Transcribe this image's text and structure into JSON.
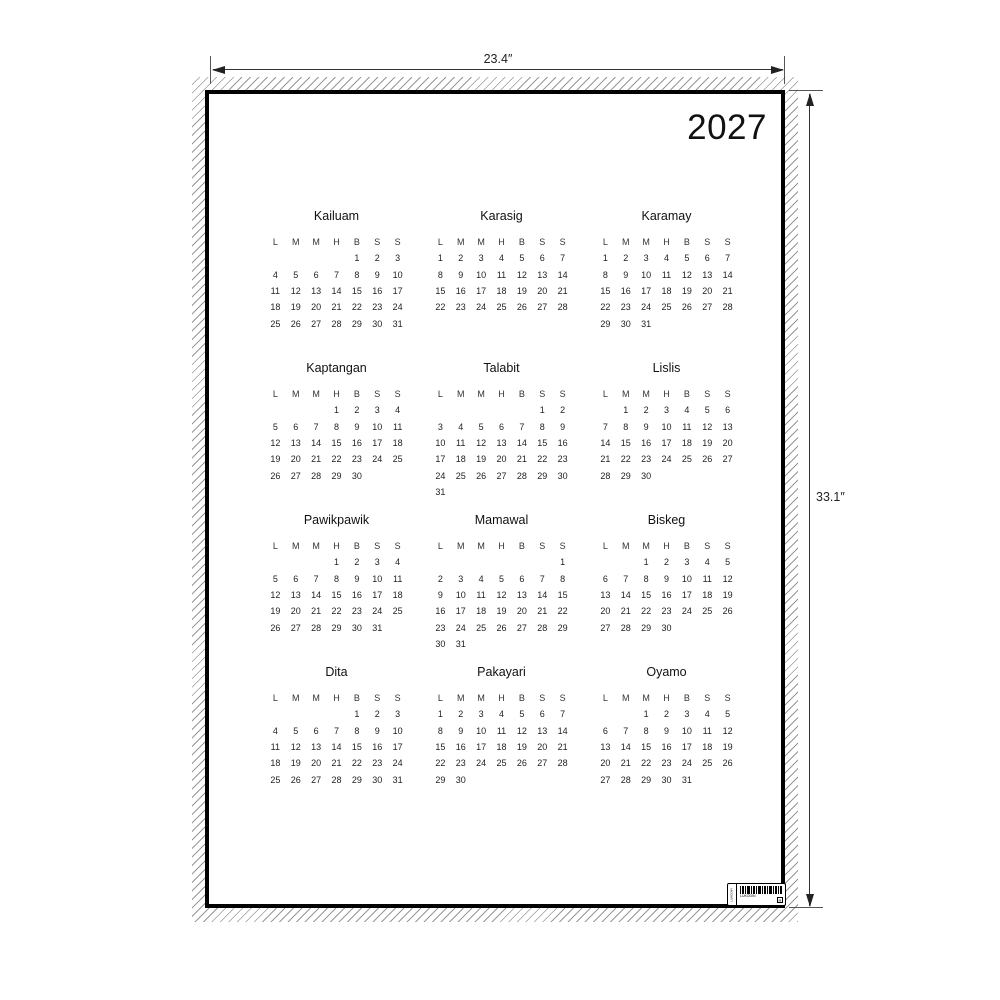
{
  "year": "2027",
  "dimensions": {
    "width_label": "23.4″",
    "height_label": "33.1″"
  },
  "weekday_letters": [
    "L",
    "M",
    "M",
    "H",
    "B",
    "S",
    "S"
  ],
  "months": [
    {
      "name": "Kailuam",
      "weeks": [
        [
          "",
          "",
          "",
          "",
          "1",
          "2",
          "3"
        ],
        [
          "4",
          "5",
          "6",
          "7",
          "8",
          "9",
          "10"
        ],
        [
          "11",
          "12",
          "13",
          "14",
          "15",
          "16",
          "17"
        ],
        [
          "18",
          "19",
          "20",
          "21",
          "22",
          "23",
          "24"
        ],
        [
          "25",
          "26",
          "27",
          "28",
          "29",
          "30",
          "31"
        ]
      ]
    },
    {
      "name": "Karasig",
      "weeks": [
        [
          "1",
          "2",
          "3",
          "4",
          "5",
          "6",
          "7"
        ],
        [
          "8",
          "9",
          "10",
          "11",
          "12",
          "13",
          "14"
        ],
        [
          "15",
          "16",
          "17",
          "18",
          "19",
          "20",
          "21"
        ],
        [
          "22",
          "23",
          "24",
          "25",
          "26",
          "27",
          "28"
        ]
      ]
    },
    {
      "name": "Karamay",
      "weeks": [
        [
          "1",
          "2",
          "3",
          "4",
          "5",
          "6",
          "7"
        ],
        [
          "8",
          "9",
          "10",
          "11",
          "12",
          "13",
          "14"
        ],
        [
          "15",
          "16",
          "17",
          "18",
          "19",
          "20",
          "21"
        ],
        [
          "22",
          "23",
          "24",
          "25",
          "26",
          "27",
          "28"
        ],
        [
          "29",
          "30",
          "31",
          "",
          "",
          "",
          ""
        ]
      ]
    },
    {
      "name": "Kaptangan",
      "weeks": [
        [
          "",
          "",
          "",
          "1",
          "2",
          "3",
          "4"
        ],
        [
          "5",
          "6",
          "7",
          "8",
          "9",
          "10",
          "11"
        ],
        [
          "12",
          "13",
          "14",
          "15",
          "16",
          "17",
          "18"
        ],
        [
          "19",
          "20",
          "21",
          "22",
          "23",
          "24",
          "25"
        ],
        [
          "26",
          "27",
          "28",
          "29",
          "30",
          "",
          ""
        ]
      ]
    },
    {
      "name": "Talabit",
      "weeks": [
        [
          "",
          "",
          "",
          "",
          "",
          "1",
          "2"
        ],
        [
          "3",
          "4",
          "5",
          "6",
          "7",
          "8",
          "9"
        ],
        [
          "10",
          "11",
          "12",
          "13",
          "14",
          "15",
          "16"
        ],
        [
          "17",
          "18",
          "19",
          "20",
          "21",
          "22",
          "23"
        ],
        [
          "24",
          "25",
          "26",
          "27",
          "28",
          "29",
          "30"
        ],
        [
          "31",
          "",
          "",
          "",
          "",
          "",
          ""
        ]
      ]
    },
    {
      "name": "Lislis",
      "weeks": [
        [
          "",
          "1",
          "2",
          "3",
          "4",
          "5",
          "6"
        ],
        [
          "7",
          "8",
          "9",
          "10",
          "11",
          "12",
          "13"
        ],
        [
          "14",
          "15",
          "16",
          "17",
          "18",
          "19",
          "20"
        ],
        [
          "21",
          "22",
          "23",
          "24",
          "25",
          "26",
          "27"
        ],
        [
          "28",
          "29",
          "30",
          "",
          "",
          "",
          ""
        ]
      ]
    },
    {
      "name": "Pawikpawik",
      "weeks": [
        [
          "",
          "",
          "",
          "1",
          "2",
          "3",
          "4"
        ],
        [
          "5",
          "6",
          "7",
          "8",
          "9",
          "10",
          "11"
        ],
        [
          "12",
          "13",
          "14",
          "15",
          "16",
          "17",
          "18"
        ],
        [
          "19",
          "20",
          "21",
          "22",
          "23",
          "24",
          "25"
        ],
        [
          "26",
          "27",
          "28",
          "29",
          "30",
          "31",
          ""
        ]
      ]
    },
    {
      "name": "Mamawal",
      "weeks": [
        [
          "",
          "",
          "",
          "",
          "",
          "",
          "1"
        ],
        [
          "2",
          "3",
          "4",
          "5",
          "6",
          "7",
          "8"
        ],
        [
          "9",
          "10",
          "11",
          "12",
          "13",
          "14",
          "15"
        ],
        [
          "16",
          "17",
          "18",
          "19",
          "20",
          "21",
          "22"
        ],
        [
          "23",
          "24",
          "25",
          "26",
          "27",
          "28",
          "29"
        ],
        [
          "30",
          "31",
          "",
          "",
          "",
          "",
          ""
        ]
      ]
    },
    {
      "name": "Biskeg",
      "weeks": [
        [
          "",
          "",
          "1",
          "2",
          "3",
          "4",
          "5"
        ],
        [
          "6",
          "7",
          "8",
          "9",
          "10",
          "11",
          "12"
        ],
        [
          "13",
          "14",
          "15",
          "16",
          "17",
          "18",
          "19"
        ],
        [
          "20",
          "21",
          "22",
          "23",
          "24",
          "25",
          "26"
        ],
        [
          "27",
          "28",
          "29",
          "30",
          "",
          "",
          ""
        ]
      ]
    },
    {
      "name": "Dita",
      "weeks": [
        [
          "",
          "",
          "",
          "",
          "1",
          "2",
          "3"
        ],
        [
          "4",
          "5",
          "6",
          "7",
          "8",
          "9",
          "10"
        ],
        [
          "11",
          "12",
          "13",
          "14",
          "15",
          "16",
          "17"
        ],
        [
          "18",
          "19",
          "20",
          "21",
          "22",
          "23",
          "24"
        ],
        [
          "25",
          "26",
          "27",
          "28",
          "29",
          "30",
          "31"
        ]
      ]
    },
    {
      "name": "Pakayari",
      "weeks": [
        [
          "1",
          "2",
          "3",
          "4",
          "5",
          "6",
          "7"
        ],
        [
          "8",
          "9",
          "10",
          "11",
          "12",
          "13",
          "14"
        ],
        [
          "15",
          "16",
          "17",
          "18",
          "19",
          "20",
          "21"
        ],
        [
          "22",
          "23",
          "24",
          "25",
          "26",
          "27",
          "28"
        ],
        [
          "29",
          "30",
          "",
          "",
          "",
          "",
          ""
        ]
      ]
    },
    {
      "name": "Oyamo",
      "weeks": [
        [
          "",
          "",
          "1",
          "2",
          "3",
          "4",
          "5"
        ],
        [
          "6",
          "7",
          "8",
          "9",
          "10",
          "11",
          "12"
        ],
        [
          "13",
          "14",
          "15",
          "16",
          "17",
          "18",
          "19"
        ],
        [
          "20",
          "21",
          "22",
          "23",
          "24",
          "25",
          "26"
        ],
        [
          "27",
          "28",
          "29",
          "30",
          "31",
          "",
          ""
        ]
      ]
    }
  ],
  "barcode": {
    "caption": "LUKODIN",
    "box_glyph": "R"
  },
  "colors": {
    "ink": "#1a1a1a",
    "hatch": "#979797",
    "border": "#000000",
    "dimension": "#333333"
  }
}
